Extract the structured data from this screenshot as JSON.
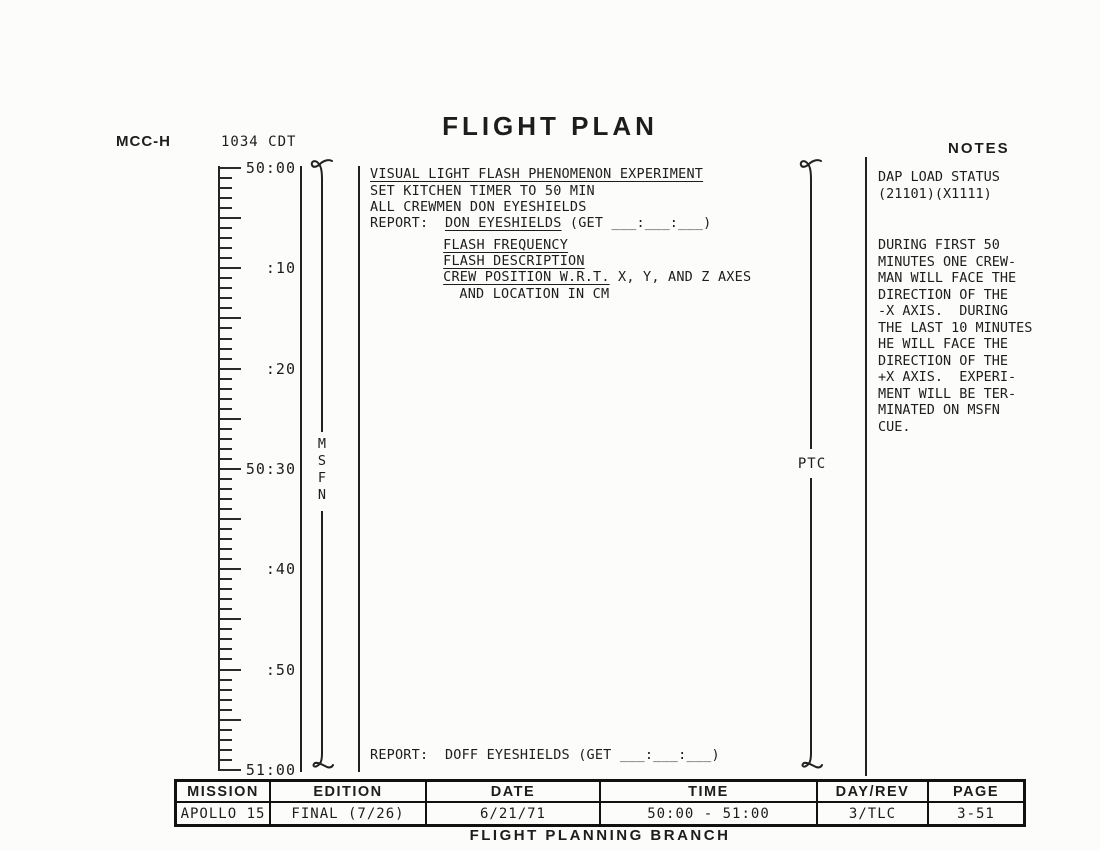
{
  "header": {
    "station": "MCC-H",
    "local_time": "1034 CDT",
    "title": "FLIGHT PLAN",
    "notes_label": "NOTES"
  },
  "timeline": {
    "start_get": "50:00",
    "end_get": "51:00",
    "total_minutes": 60,
    "labels": [
      {
        "text": "50:00",
        "minute": 0
      },
      {
        "text": ":10",
        "minute": 10
      },
      {
        "text": ":20",
        "minute": 20
      },
      {
        "text": "50:30",
        "minute": 30
      },
      {
        "text": ":40",
        "minute": 40
      },
      {
        "text": ":50",
        "minute": 50
      },
      {
        "text": "51:00",
        "minute": 60
      }
    ],
    "msfn_label": "MSFN",
    "ptc_label": "PTC"
  },
  "activities": {
    "lines": [
      {
        "prefix": "",
        "text": "VISUAL LIGHT FLASH PHENOMENON EXPERIMENT",
        "underline": true,
        "suffix": "",
        "indent": 0
      },
      {
        "prefix": "",
        "text": "SET KITCHEN TIMER TO 50 MIN",
        "underline": false,
        "suffix": "",
        "indent": 0
      },
      {
        "prefix": "",
        "text": "ALL CREWMEN DON EYESHIELDS",
        "underline": false,
        "suffix": "",
        "indent": 0
      },
      {
        "prefix": "REPORT:  ",
        "text": "DON EYESHIELDS",
        "underline": true,
        "suffix": " (GET ___:___:___)",
        "indent": 0
      },
      {
        "prefix": "",
        "text": "FLASH FREQUENCY",
        "underline": true,
        "suffix": "",
        "indent": 9
      },
      {
        "prefix": "",
        "text": "FLASH DESCRIPTION",
        "underline": true,
        "suffix": "",
        "indent": 9
      },
      {
        "prefix": "",
        "text": "CREW POSITION W.R.T.",
        "underline": true,
        "suffix": " X, Y, AND Z AXES",
        "indent": 9
      },
      {
        "prefix": "",
        "text": "AND LOCATION IN CM",
        "underline": false,
        "suffix": "",
        "indent": 11
      },
      {
        "prefix": "REPORT:  ",
        "text": "DOFF EYESHIELDS (GET ___:___:___)",
        "underline": false,
        "suffix": "",
        "indent": 0
      }
    ]
  },
  "notes": {
    "heading_lines": [
      "DAP LOAD STATUS",
      "(21101)(X1111)"
    ],
    "body_lines": [
      "DURING FIRST 50",
      "MINUTES ONE CREW-",
      "MAN WILL FACE THE",
      "DIRECTION OF THE",
      "-X AXIS.  DURING",
      "THE LAST 10 MINUTES",
      "HE WILL FACE THE",
      "DIRECTION OF THE",
      "+X AXIS.  EXPERI-",
      "MENT WILL BE TER-",
      "MINATED ON MSFN",
      "CUE."
    ]
  },
  "footer_table": {
    "columns": [
      {
        "header": "MISSION",
        "value": "APOLLO 15"
      },
      {
        "header": "EDITION",
        "value": "FINAL (7/26)"
      },
      {
        "header": "DATE",
        "value": "6/21/71"
      },
      {
        "header": "TIME",
        "value": "50:00 - 51:00"
      },
      {
        "header": "DAY/REV",
        "value": "3/TLC"
      },
      {
        "header": "PAGE",
        "value": "3-51"
      }
    ],
    "branch": "FLIGHT PLANNING BRANCH"
  }
}
